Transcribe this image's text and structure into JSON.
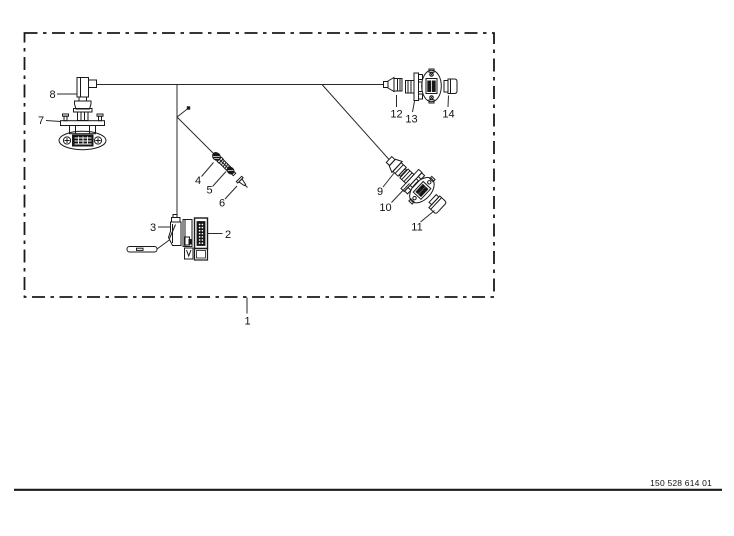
{
  "page": {
    "background_color": "#ffffff",
    "line_color": "#1a1a1a"
  },
  "diagram": {
    "type": "exploded-parts-diagram",
    "callouts": [
      "1",
      "2",
      "3",
      "4",
      "5",
      "6",
      "7",
      "8",
      "9",
      "10",
      "11",
      "12",
      "13",
      "14"
    ]
  },
  "footer": {
    "drawing_number": "150 528 614 01"
  }
}
